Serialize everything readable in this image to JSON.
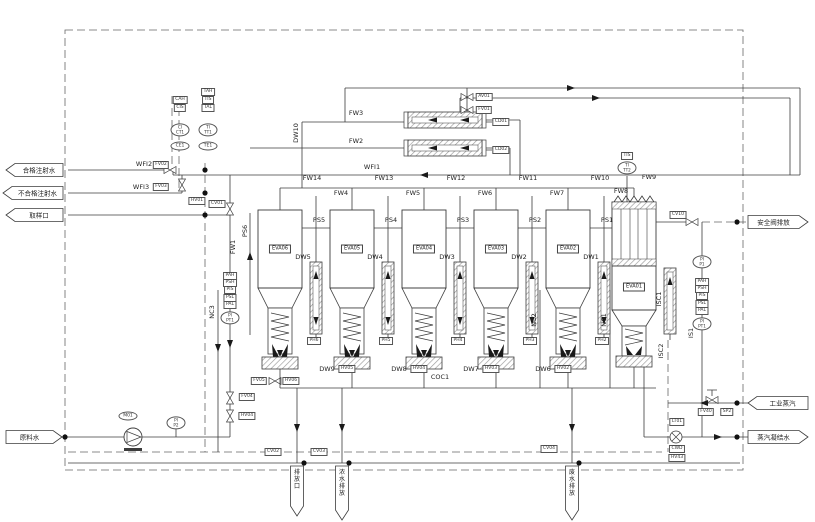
{
  "io": [
    {
      "name": "qualified-wfi-out",
      "label": "合格注射水",
      "x": 6,
      "y": 170,
      "dir": "left",
      "w": 57,
      "h": 13
    },
    {
      "name": "unqualified-wfi-out",
      "label": "不合格注射水",
      "x": 3,
      "y": 193,
      "dir": "left",
      "w": 60,
      "h": 13
    },
    {
      "name": "sample-port-out",
      "label": "取样口",
      "x": 6,
      "y": 215,
      "dir": "left",
      "w": 57,
      "h": 13
    },
    {
      "name": "feed-water-in",
      "label": "原料水",
      "x": 6,
      "y": 437,
      "dir": "right",
      "w": 56,
      "h": 13
    },
    {
      "name": "safety-valve-vent",
      "label": "安全阀排放",
      "x": 748,
      "y": 222,
      "dir": "right",
      "w": 60,
      "h": 13
    },
    {
      "name": "industrial-steam-in",
      "label": "工业蒸汽",
      "x": 748,
      "y": 403,
      "dir": "left",
      "w": 60,
      "h": 13
    },
    {
      "name": "steam-condensate-out",
      "label": "蒸汽凝结水",
      "x": 748,
      "y": 437,
      "dir": "right",
      "w": 60,
      "h": 13
    },
    {
      "name": "drain-1",
      "label": "排放口",
      "x": 297,
      "y": 466,
      "dir": "down",
      "w": 13,
      "h": 50
    },
    {
      "name": "drain-2",
      "label": "浓水排放",
      "x": 342,
      "y": 466,
      "dir": "down",
      "w": 13,
      "h": 54
    },
    {
      "name": "drain-3",
      "label": "废水排放",
      "x": 572,
      "y": 466,
      "dir": "down",
      "w": 13,
      "h": 54
    }
  ],
  "units": [
    {
      "id": "EVA06",
      "x": 258,
      "fw_top": "FW14",
      "ps_out": "PS5",
      "side_line": "DW5",
      "preheater_tag": "PH6"
    },
    {
      "id": "EVA05",
      "x": 330,
      "fw_top": "FW13",
      "fw_feed": "FW4",
      "ps_out": "PS4",
      "side_line": "DW4",
      "preheater_tag": "PH5",
      "drain": "DW9",
      "drain_valve": "HV05"
    },
    {
      "id": "EVA04",
      "x": 402,
      "fw_top": "FW12",
      "fw_feed": "FW5",
      "ps_out": "PS3",
      "side_line": "DW3",
      "preheater_tag": "PH4",
      "drain": "DW8",
      "drain_valve": "HV04"
    },
    {
      "id": "EVA03",
      "x": 474,
      "fw_top": "FW11",
      "fw_feed": "FW6",
      "ps_out": "PS2",
      "side_line": "DW2",
      "preheater_tag": "PH3",
      "drain": "DW7",
      "drain_valve": "HV03"
    },
    {
      "id": "EVA02",
      "x": 546,
      "fw_top": "FW10",
      "fw_feed": "FW7",
      "ps_out": "PS1",
      "side_line": "DW1",
      "preheater_tag": "PH2",
      "drain": "DW6",
      "drain_valve": "HV02"
    },
    {
      "id": "EVA01",
      "x": 612,
      "special": true,
      "fw_top": "FW9",
      "fw_feed": "FW8",
      "side_line": "ISC1",
      "instrument_tag": "TIS",
      "instrument": "TI|TT2"
    }
  ],
  "labels": [
    {
      "t": "WFI2",
      "x": 144,
      "y": 164
    },
    {
      "t": "FV02",
      "x": 161,
      "y": 165,
      "k": "t"
    },
    {
      "t": "WFI3",
      "x": 141,
      "y": 187
    },
    {
      "t": "FV03",
      "x": 161,
      "y": 187,
      "k": "t"
    },
    {
      "t": "HV01",
      "x": 197,
      "y": 201,
      "k": "t"
    },
    {
      "t": "CV01",
      "x": 217,
      "y": 204,
      "k": "t"
    },
    {
      "t": "WFI1",
      "x": 372,
      "y": 167
    },
    {
      "t": "FW2",
      "x": 356,
      "y": 141
    },
    {
      "t": "FW3",
      "x": 356,
      "y": 113
    },
    {
      "t": "FW1",
      "x": 233,
      "y": 247,
      "k": "v"
    },
    {
      "t": "DW10",
      "x": 296,
      "y": 133,
      "k": "v"
    },
    {
      "t": "PS6",
      "x": 245,
      "y": 231,
      "k": "v"
    },
    {
      "t": "NC3",
      "x": 212,
      "y": 312,
      "k": "v"
    },
    {
      "t": "NC2",
      "x": 534,
      "y": 320,
      "k": "v"
    },
    {
      "t": "NC1",
      "x": 604,
      "y": 320,
      "k": "v"
    },
    {
      "t": "IS1",
      "x": 691,
      "y": 333,
      "k": "v"
    },
    {
      "t": "ISC1",
      "x": 659,
      "y": 299,
      "k": "v"
    },
    {
      "t": "ISC2",
      "x": 661,
      "y": 351,
      "k": "v"
    },
    {
      "t": "COC1",
      "x": 440,
      "y": 377
    },
    {
      "t": "AV01",
      "x": 484,
      "y": 97,
      "k": "t"
    },
    {
      "t": "FV01",
      "x": 484,
      "y": 110,
      "k": "t"
    },
    {
      "t": "CD01",
      "x": 501,
      "y": 122,
      "k": "t"
    },
    {
      "t": "CD02",
      "x": 501,
      "y": 150,
      "k": "t"
    },
    {
      "t": "CV10",
      "x": 678,
      "y": 215,
      "k": "t"
    },
    {
      "t": "FV05",
      "x": 259,
      "y": 381,
      "k": "t"
    },
    {
      "t": "HV06",
      "x": 291,
      "y": 381,
      "k": "t"
    },
    {
      "t": "FV04",
      "x": 247,
      "y": 397,
      "k": "t"
    },
    {
      "t": "HV04",
      "x": 247,
      "y": 416,
      "k": "t"
    },
    {
      "t": "CV02",
      "x": 273,
      "y": 452,
      "k": "t"
    },
    {
      "t": "CV03",
      "x": 319,
      "y": 452,
      "k": "t"
    },
    {
      "t": "CV04",
      "x": 549,
      "y": 449,
      "k": "t"
    },
    {
      "t": "FV40",
      "x": 706,
      "y": 412,
      "k": "t"
    },
    {
      "t": "SP2",
      "x": 727,
      "y": 412,
      "k": "t"
    },
    {
      "t": "LT01",
      "x": 677,
      "y": 422,
      "k": "t"
    },
    {
      "t": "CWD",
      "x": 677,
      "y": 449,
      "k": "t"
    },
    {
      "t": "HV43",
      "x": 677,
      "y": 458,
      "k": "t"
    },
    {
      "t": "M01",
      "x": 128,
      "y": 416,
      "k": "o"
    },
    {
      "t": "PI|P2",
      "x": 176,
      "y": 423,
      "k": "o2"
    },
    {
      "t": "PI|P1",
      "x": 702,
      "y": 262,
      "k": "o2"
    },
    {
      "t": "CAH",
      "x": 180,
      "y": 100,
      "k": "t"
    },
    {
      "t": "CIS",
      "x": 180,
      "y": 108,
      "k": "t"
    },
    {
      "t": "CI|CT1",
      "x": 180,
      "y": 130,
      "k": "o2"
    },
    {
      "t": "CE1",
      "x": 180,
      "y": 146,
      "k": "o"
    },
    {
      "t": "TAH",
      "x": 208,
      "y": 92,
      "k": "t"
    },
    {
      "t": "TIS",
      "x": 208,
      "y": 100,
      "k": "t"
    },
    {
      "t": "TAL",
      "x": 208,
      "y": 108,
      "k": "t"
    },
    {
      "t": "TI|TT1",
      "x": 208,
      "y": 130,
      "k": "o2"
    },
    {
      "t": "TE1",
      "x": 208,
      "y": 146,
      "k": "o"
    }
  ],
  "stacks": [
    {
      "name": "feed-line-pressure-stack",
      "x": 230,
      "y": 276,
      "boxes": [
        "PAH",
        "PSH",
        "PIS",
        "PSL",
        "PAL"
      ],
      "oval": "PI|PT1"
    },
    {
      "name": "steam-pressure-stack",
      "x": 702,
      "y": 282,
      "boxes": [
        "PAH",
        "PSH",
        "PIS",
        "PSL",
        "PAL"
      ],
      "oval": "PI|PT1"
    }
  ],
  "colors": {
    "pipe": "#3c3c3c",
    "dash": "#666",
    "hatch": "#9a9a9a",
    "fill": "#1a1a1a"
  }
}
